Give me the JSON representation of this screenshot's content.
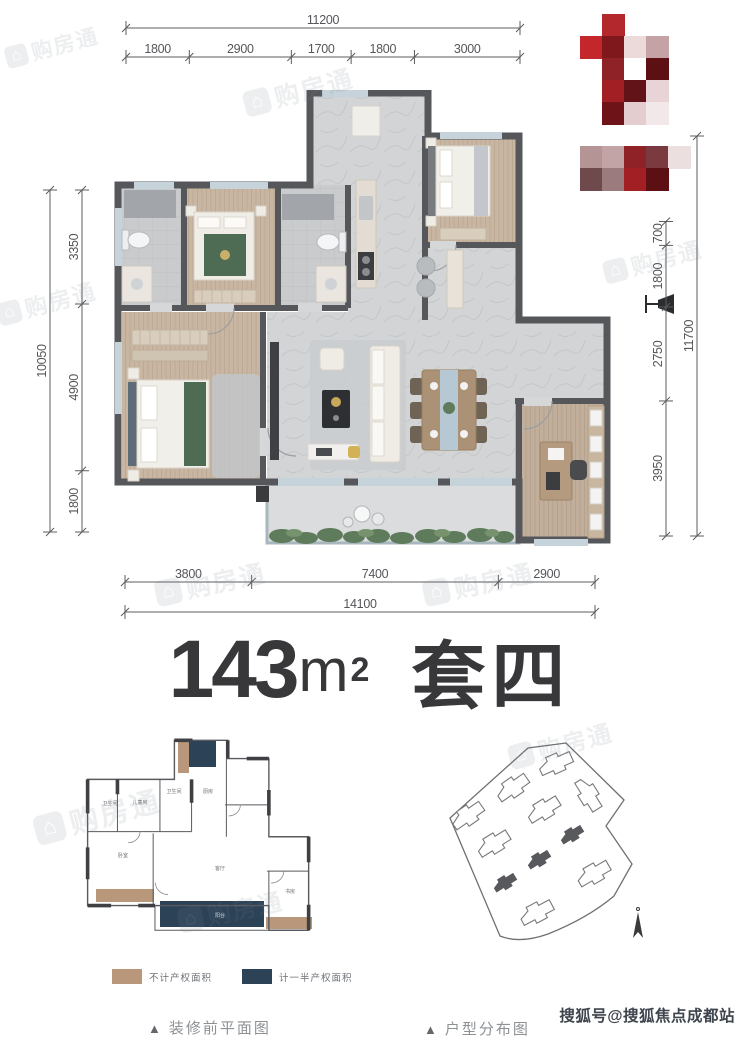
{
  "title": {
    "area": "143",
    "unit": "m",
    "exp": "2",
    "suite": "套四"
  },
  "dimensions": {
    "top": {
      "total": "11200",
      "segments": [
        "1800",
        "2900",
        "1700",
        "1800",
        "3000"
      ]
    },
    "bottom": {
      "total": "14100",
      "segments": [
        "3800",
        "7400",
        "2900"
      ]
    },
    "left": {
      "total": "10050",
      "segments": [
        "3350",
        "4900",
        "1800"
      ]
    },
    "right": {
      "total": "11700",
      "segments": [
        "700",
        "1800",
        "2750",
        "3950"
      ]
    }
  },
  "legend": {
    "items": [
      {
        "label": "不计产权面积",
        "color": "#b8977a"
      },
      {
        "label": "计一半产权面积",
        "color": "#2c4257"
      }
    ]
  },
  "captions": {
    "marker": "▲",
    "left": "装修前平面图",
    "right": "户型分布图"
  },
  "watermarks": {
    "sohu": "搜狐号@搜狐焦点成都站",
    "logo_text": "购房通",
    "positions": [
      {
        "x": 240,
        "y": 88,
        "r": -15,
        "s": 1
      },
      {
        "x": 2,
        "y": 44,
        "r": -15,
        "s": 0.85
      },
      {
        "x": -6,
        "y": 300,
        "r": -15,
        "s": 0.9
      },
      {
        "x": 600,
        "y": 258,
        "r": -15,
        "s": 0.9
      },
      {
        "x": 152,
        "y": 577,
        "r": -12,
        "s": 1
      },
      {
        "x": 420,
        "y": 577,
        "r": -12,
        "s": 1
      },
      {
        "x": 30,
        "y": 812,
        "r": -15,
        "s": 1.15
      },
      {
        "x": 175,
        "y": 905,
        "r": -12,
        "s": 0.95
      },
      {
        "x": 505,
        "y": 742,
        "r": -15,
        "s": 0.95
      }
    ]
  },
  "small_plan": {
    "labels": [
      {
        "t": "卫生间",
        "x": 40,
        "y": 72
      },
      {
        "t": "儿童房",
        "x": 70,
        "y": 71
      },
      {
        "t": "卫生间",
        "x": 104,
        "y": 60
      },
      {
        "t": "厨房",
        "x": 138,
        "y": 60
      },
      {
        "t": "卧室",
        "x": 53,
        "y": 124
      },
      {
        "t": "客厅",
        "x": 150,
        "y": 137
      },
      {
        "t": "书房",
        "x": 220,
        "y": 160
      },
      {
        "t": "阳台",
        "x": 150,
        "y": 184,
        "c": "#d8dde2"
      }
    ]
  },
  "mosaic": {
    "origin": [
      580,
      14
    ],
    "cell": 22,
    "cells": [
      [
        1,
        0,
        "#b3282d"
      ],
      [
        0,
        1,
        "#c3272b"
      ],
      [
        1,
        1,
        "#7e181d"
      ],
      [
        2,
        1,
        "#ecd9da"
      ],
      [
        3,
        1,
        "#c5a2a5"
      ],
      [
        1,
        2,
        "#8e2227"
      ],
      [
        2,
        2,
        "#ffffff"
      ],
      [
        3,
        2,
        "#5d1013"
      ],
      [
        1,
        3,
        "#a21f24"
      ],
      [
        2,
        3,
        "#621317"
      ],
      [
        3,
        3,
        "#e8d4d6"
      ],
      [
        1,
        4,
        "#6e1418"
      ],
      [
        2,
        4,
        "#e3cdcf"
      ],
      [
        3,
        4,
        "#f2e8e9"
      ],
      [
        0,
        6,
        "#b59496"
      ],
      [
        1,
        6,
        "#c2a4a6"
      ],
      [
        2,
        6,
        "#8e2227"
      ],
      [
        3,
        6,
        "#7b3a3f"
      ],
      [
        4,
        6,
        "#ecdfe0"
      ],
      [
        0,
        7,
        "#6f4a4d"
      ],
      [
        1,
        7,
        "#9b7b7e"
      ],
      [
        2,
        7,
        "#a21f24"
      ],
      [
        3,
        7,
        "#5d1013"
      ]
    ]
  },
  "colors": {
    "wall": "#56575b",
    "wood_floor": "#c8b6a3",
    "tile_floor": "#caccce",
    "marble_floor": "#d3d4d6",
    "window": "#c6d3da",
    "bed_green": "#4e6b54",
    "plant_green": "#5e7c5b",
    "dim_text": "#55565a",
    "title_text": "#38383b"
  }
}
